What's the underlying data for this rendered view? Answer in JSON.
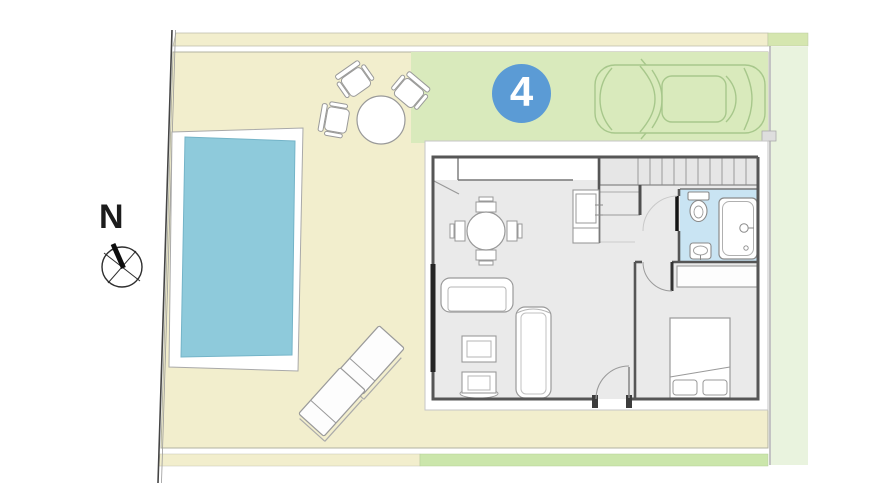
{
  "plan": {
    "unit_badge": {
      "number": "4"
    },
    "compass": {
      "label": "N"
    },
    "colors": {
      "yard": "#f2eecd",
      "driveway": "#d9eabc",
      "hedge": "#cbe6ab",
      "sidestrip": "#e9f3de",
      "topstripgreen": "#d5e6af",
      "pool": "#8ecadb",
      "pooledge": "#74b4c8",
      "bath": "#c9e4f3",
      "floor": "#eaeaea",
      "badge": "#5b9bd5",
      "car": "#a7c78b",
      "wall": "#565656"
    },
    "legend_objects": [
      "plot-boundary",
      "yard",
      "driveway",
      "side-strip",
      "hedge-strip",
      "swimming-pool",
      "outdoor-dining-set",
      "sun-loungers",
      "car",
      "north-arrow",
      "unit-badge",
      "house-floor-plan",
      "stairs",
      "kitchen-counter",
      "dining-table",
      "sofa",
      "coffee-table",
      "armchair",
      "chaise-longue",
      "bed",
      "wardrobe",
      "toilet",
      "bathtub",
      "bathroom-sink"
    ]
  }
}
